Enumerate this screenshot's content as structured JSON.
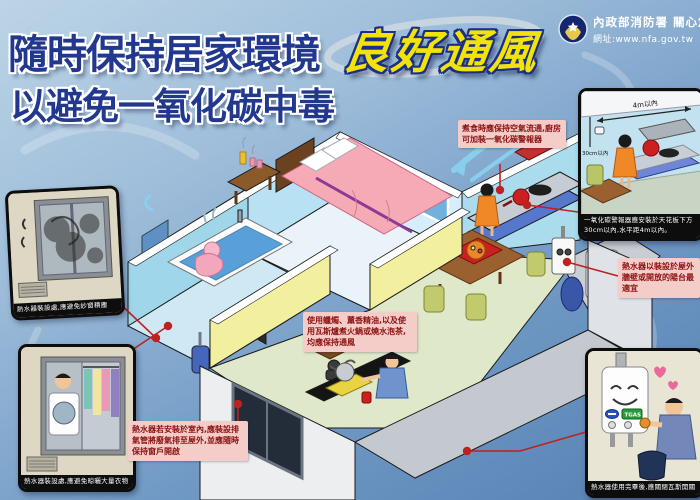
{
  "header": {
    "title_line1": "隨時保持居家環境",
    "title_highlight": "良好通風",
    "title_line2": "以避免一氧化碳中毒",
    "agency_name": "內政部消防署 關心您",
    "website": "網址:www.nfa.gov.tw"
  },
  "annotations": {
    "cooking": "煮食時應保持空氣流通,廚房可加裝一氧化碳警報器",
    "candles": "使用蠟燭、薰香精油,以及使用瓦斯爐煮火鍋或燒水泡茶,均應保持通風",
    "indoor_heater": "熱水器若安裝於室內,應裝設排氣管將廢氣排至屋外,並應隨時保持窗戶開啟",
    "outdoor_heater": "熱水器以裝設於屋外牆壁或開放的陽台最適宜"
  },
  "callouts": {
    "screen_dust": {
      "caption": "熱水器裝設處,應避免紗窗積塵"
    },
    "clothes": {
      "caption": "熱水器裝設處,應避免晾曬大量衣物"
    },
    "co_alarm": {
      "caption": "一氧化碳警報器應安裝於天花板下方30cm以內,水平距4m以內。",
      "label_top": "4m以內",
      "label_left": "30cm以內"
    },
    "gas_valve": {
      "caption": "熱水器使用完畢後,應關閉瓦斯開關",
      "heater_label": "TGAS"
    }
  },
  "colors": {
    "background_top": "#bcd4e6",
    "background_bottom": "#5580b2",
    "title_navy": "#22388f",
    "title_yellow": "#f2e409",
    "annotation_bg": "#f4cdc9",
    "annotation_text": "#8c1212",
    "leader_red": "#c02020"
  }
}
